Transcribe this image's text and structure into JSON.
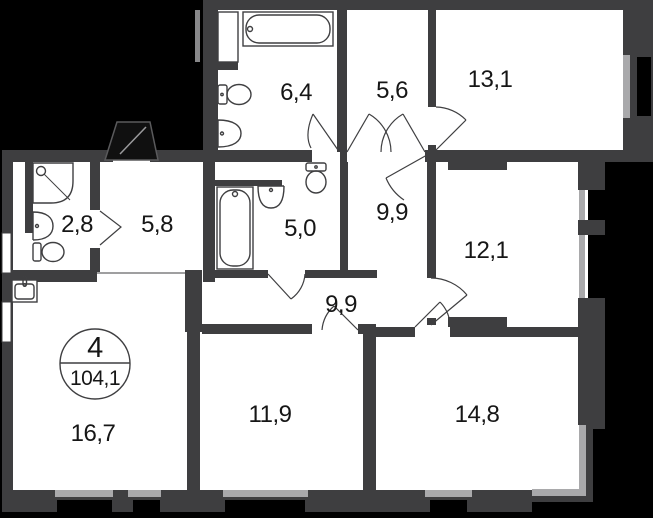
{
  "badge": {
    "room_count": "4",
    "total_area": "104,1"
  },
  "rooms": [
    {
      "id": "bathroom-top",
      "area": "6,4"
    },
    {
      "id": "wardrobe",
      "area": "5,6"
    },
    {
      "id": "bedroom-top",
      "area": "13,1"
    },
    {
      "id": "shower-room",
      "area": "2,8"
    },
    {
      "id": "entry-hall",
      "area": "5,8"
    },
    {
      "id": "bathroom-mid",
      "area": "5,0"
    },
    {
      "id": "corridor-top",
      "area": "9,9"
    },
    {
      "id": "bedroom-right",
      "area": "12,1"
    },
    {
      "id": "corridor-main",
      "area": "9,9"
    },
    {
      "id": "living-kitchen",
      "area": "16,7"
    },
    {
      "id": "bedroom-bottom",
      "area": "11,9"
    },
    {
      "id": "bedroom-corner",
      "area": "14,8"
    }
  ],
  "colors": {
    "background": "#000000",
    "wall": "#3E3E40",
    "floor": "#FFFFFF",
    "window": "#A9A9AB",
    "label_text": "#161616"
  }
}
